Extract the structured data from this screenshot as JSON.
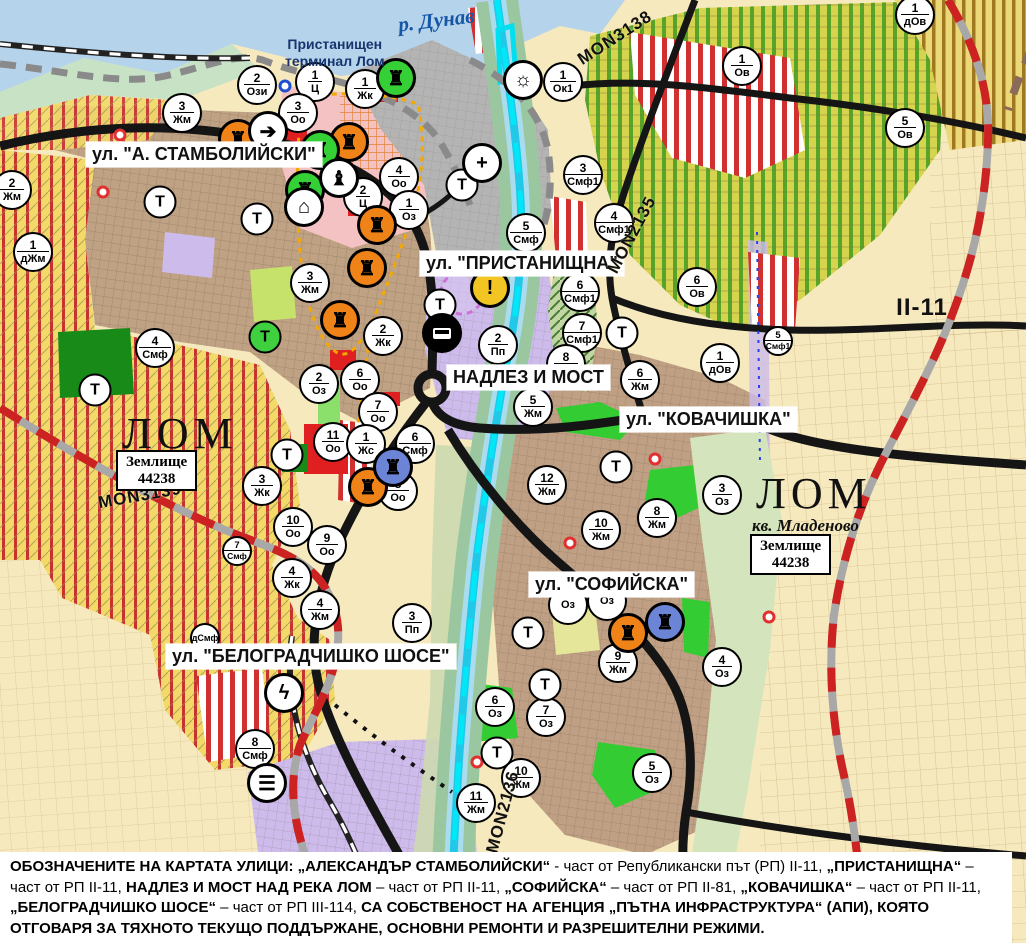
{
  "map": {
    "street_labels": [
      {
        "text": "ул. \"А. СТАМБОЛИЙСКИ\"",
        "x": 86,
        "y": 142
      },
      {
        "text": "ул. \"ПРИСТАНИЩНА\"",
        "x": 420,
        "y": 251
      },
      {
        "text": "НАДЛЕЗ И МОСТ",
        "x": 447,
        "y": 365
      },
      {
        "text": "ул. \"КОВАЧИШКА\"",
        "x": 620,
        "y": 407
      },
      {
        "text": "ул. \"СОФИЙСКА\"",
        "x": 529,
        "y": 572
      },
      {
        "text": "ул. \"БЕЛОГРАДЧИШКО ШОСЕ\"",
        "x": 166,
        "y": 644
      }
    ],
    "river_label": {
      "text": "р. Дунав",
      "x": 398,
      "y": 8,
      "rot": -7
    },
    "terminal_label": {
      "text": "Пристанищен\nтерминал Лом",
      "x": 285,
      "y": 36
    },
    "city_labels": [
      {
        "text": "ЛОМ",
        "x": 122,
        "y": 412
      },
      {
        "text": "ЛОМ",
        "x": 756,
        "y": 472
      }
    ],
    "quarter_label": {
      "text": "кв. Младеново",
      "x": 752,
      "y": 516
    },
    "land_boxes": [
      {
        "text": "Землище\n44238",
        "x": 116,
        "y": 450
      },
      {
        "text": "Землище\n44238",
        "x": 750,
        "y": 534
      }
    ],
    "road_labels": [
      {
        "text": "MON3138",
        "x": 615,
        "y": 38,
        "rot": -33,
        "fs": 17
      },
      {
        "text": "MON2135",
        "x": 632,
        "y": 235,
        "rot": -62,
        "fs": 17
      },
      {
        "text": "MON3139",
        "x": 140,
        "y": 496,
        "rot": -10,
        "fs": 17
      },
      {
        "text": "MON2136",
        "x": 503,
        "y": 812,
        "rot": -75,
        "fs": 17
      },
      {
        "text": "II-11",
        "x": 922,
        "y": 308,
        "rot": 0,
        "fs": 24
      }
    ],
    "zone_markers": [
      {
        "num": "2",
        "code": "Ози",
        "x": 257,
        "y": 85
      },
      {
        "num": "1",
        "code": "Ц",
        "x": 315,
        "y": 82
      },
      {
        "num": "3",
        "code": "Оо",
        "x": 298,
        "y": 113
      },
      {
        "num": "1",
        "code": "Жк",
        "x": 365,
        "y": 89
      },
      {
        "num": "1",
        "code": "Ок1",
        "x": 563,
        "y": 82
      },
      {
        "num": "3",
        "code": "Жм",
        "x": 182,
        "y": 113
      },
      {
        "num": "2",
        "code": "Жм",
        "x": 12,
        "y": 190
      },
      {
        "num": "1",
        "code": "дЖм",
        "x": 33,
        "y": 252
      },
      {
        "num": "4",
        "code": "Оо",
        "x": 399,
        "y": 177
      },
      {
        "num": "2",
        "code": "Ц",
        "x": 363,
        "y": 197
      },
      {
        "num": "1",
        "code": "Оз",
        "x": 409,
        "y": 210
      },
      {
        "num": "3",
        "code": "Смф1",
        "x": 583,
        "y": 175
      },
      {
        "num": "5",
        "code": "Смф",
        "x": 526,
        "y": 233
      },
      {
        "num": "4",
        "code": "Смф1",
        "x": 614,
        "y": 223
      },
      {
        "num": "6",
        "code": "Ов",
        "x": 697,
        "y": 287
      },
      {
        "num": "1",
        "code": "Ов",
        "x": 742,
        "y": 66
      },
      {
        "num": "5",
        "code": "Ов",
        "x": 905,
        "y": 128
      },
      {
        "num": "1",
        "code": "дОв",
        "x": 915,
        "y": 15
      },
      {
        "num": "1",
        "code": "дОв",
        "x": 720,
        "y": 363
      },
      {
        "num": "6",
        "code": "Смф1",
        "x": 580,
        "y": 292
      },
      {
        "num": "7",
        "code": "Смф1",
        "x": 582,
        "y": 333
      },
      {
        "num": "5",
        "code": "Смф1",
        "x": 778,
        "y": 341,
        "small": true
      },
      {
        "num": "3",
        "code": "Жм",
        "x": 310,
        "y": 283
      },
      {
        "num": "2",
        "code": "Жк",
        "x": 383,
        "y": 336
      },
      {
        "num": "4",
        "code": "Смф",
        "x": 155,
        "y": 348
      },
      {
        "num": "2",
        "code": "Пп",
        "x": 498,
        "y": 345
      },
      {
        "num": "2",
        "code": "Оз",
        "x": 319,
        "y": 384
      },
      {
        "num": "6",
        "code": "Оо",
        "x": 360,
        "y": 380
      },
      {
        "num": "7",
        "code": "Оо",
        "x": 378,
        "y": 412
      },
      {
        "num": "11",
        "code": "Оо",
        "x": 333,
        "y": 442
      },
      {
        "num": "1",
        "code": "Жс",
        "x": 366,
        "y": 444
      },
      {
        "num": "6",
        "code": "Смф",
        "x": 415,
        "y": 444
      },
      {
        "num": "8",
        "code": "Оо",
        "x": 398,
        "y": 491
      },
      {
        "num": "3",
        "code": "Жк",
        "x": 262,
        "y": 486
      },
      {
        "num": "10",
        "code": "Оо",
        "x": 293,
        "y": 527
      },
      {
        "num": "9",
        "code": "Оо",
        "x": 327,
        "y": 545
      },
      {
        "num": "4",
        "code": "Жк",
        "x": 292,
        "y": 578
      },
      {
        "num": "4",
        "code": "Жм",
        "x": 320,
        "y": 610
      },
      {
        "num": "3",
        "code": "Пп",
        "x": 412,
        "y": 623
      },
      {
        "num": "7",
        "code": "Смф",
        "x": 237,
        "y": 551,
        "small": true
      },
      {
        "num": "",
        "code": "дСмф",
        "x": 205,
        "y": 638,
        "small": true
      },
      {
        "num": "8",
        "code": "Смф",
        "x": 255,
        "y": 749
      },
      {
        "num": "8",
        "code": "Жм",
        "x": 566,
        "y": 364
      },
      {
        "num": "6",
        "code": "Жм",
        "x": 640,
        "y": 380
      },
      {
        "num": "5",
        "code": "Жм",
        "x": 533,
        "y": 407
      },
      {
        "num": "12",
        "code": "Жм",
        "x": 547,
        "y": 485
      },
      {
        "num": "8",
        "code": "Жм",
        "x": 657,
        "y": 518
      },
      {
        "num": "10",
        "code": "Жм",
        "x": 601,
        "y": 530
      },
      {
        "num": "3",
        "code": "Оз",
        "x": 722,
        "y": 495
      },
      {
        "num": "",
        "code": "Оз",
        "x": 568,
        "y": 605
      },
      {
        "num": "",
        "code": "Оз",
        "x": 607,
        "y": 601
      },
      {
        "num": "9",
        "code": "Жм",
        "x": 618,
        "y": 663
      },
      {
        "num": "6",
        "code": "Оз",
        "x": 495,
        "y": 707
      },
      {
        "num": "7",
        "code": "Оз",
        "x": 546,
        "y": 717
      },
      {
        "num": "10",
        "code": "Жм",
        "x": 521,
        "y": 778
      },
      {
        "num": "11",
        "code": "Жм",
        "x": 476,
        "y": 803
      },
      {
        "num": "5",
        "code": "Оз",
        "x": 652,
        "y": 773
      },
      {
        "num": "4",
        "code": "Оз",
        "x": 722,
        "y": 667
      }
    ],
    "t_markers": [
      {
        "x": 160,
        "y": 202
      },
      {
        "x": 257,
        "y": 219
      },
      {
        "x": 95,
        "y": 390
      },
      {
        "x": 265,
        "y": 337,
        "bg": "#3fd03f"
      },
      {
        "x": 287,
        "y": 455
      },
      {
        "x": 440,
        "y": 305
      },
      {
        "x": 462,
        "y": 185
      },
      {
        "x": 622,
        "y": 333
      },
      {
        "x": 616,
        "y": 467
      },
      {
        "x": 528,
        "y": 633
      },
      {
        "x": 545,
        "y": 685
      },
      {
        "x": 497,
        "y": 753
      }
    ],
    "poi_icons": [
      {
        "name": "industry-icon",
        "glyph": "♜",
        "bg": "#ef8318",
        "x": 238,
        "y": 139
      },
      {
        "name": "industry-icon",
        "glyph": "♜",
        "bg": "#ef8318",
        "x": 349,
        "y": 142
      },
      {
        "name": "industry-icon",
        "glyph": "♜",
        "bg": "#ef8318",
        "x": 377,
        "y": 225
      },
      {
        "name": "industry-icon",
        "glyph": "♜",
        "bg": "#ef8318",
        "x": 367,
        "y": 268
      },
      {
        "name": "industry-icon",
        "glyph": "♜",
        "bg": "#ef8318",
        "x": 340,
        "y": 320
      },
      {
        "name": "industry-icon",
        "glyph": "♜",
        "bg": "#ef8318",
        "x": 368,
        "y": 487
      },
      {
        "name": "industry-icon",
        "glyph": "♜",
        "bg": "#ef8318",
        "x": 628,
        "y": 633
      },
      {
        "name": "industry-icon-blue",
        "glyph": "♜",
        "bg": "#6b84d6",
        "x": 393,
        "y": 467
      },
      {
        "name": "industry-icon-blue",
        "glyph": "♜",
        "bg": "#6b84d6",
        "x": 665,
        "y": 622
      },
      {
        "name": "industry-icon-green",
        "glyph": "♜",
        "bg": "#35d035",
        "x": 320,
        "y": 150
      },
      {
        "name": "industry-icon-green",
        "glyph": "♜",
        "bg": "#35d035",
        "x": 305,
        "y": 190
      },
      {
        "name": "port-terminal-icon",
        "glyph": "♜",
        "bg": "#35d035",
        "x": 396,
        "y": 78
      },
      {
        "name": "one-way-icon",
        "glyph": "➔",
        "bg": "#ffffff",
        "x": 268,
        "y": 131
      },
      {
        "name": "monument-icon",
        "glyph": "♝",
        "bg": "#ffffff",
        "x": 339,
        "y": 178
      },
      {
        "name": "arch-icon",
        "glyph": "⌂",
        "bg": "#ffffff",
        "x": 304,
        "y": 207
      },
      {
        "name": "hospital-icon",
        "glyph": "+",
        "bg": "#ffffff",
        "x": 482,
        "y": 163
      },
      {
        "name": "sun-port-icon",
        "glyph": "☼",
        "bg": "#ffffff",
        "x": 523,
        "y": 80
      },
      {
        "name": "bus-station-icon",
        "glyph": "bus",
        "bg": "#000000",
        "x": 442,
        "y": 333
      },
      {
        "name": "power-icon",
        "glyph": "ϟ",
        "bg": "#ffffff",
        "x": 284,
        "y": 693
      },
      {
        "name": "rail-station-icon",
        "glyph": "☰",
        "bg": "#ffffff",
        "x": 267,
        "y": 783
      },
      {
        "name": "warning-icon",
        "glyph": "!",
        "bg": "#f3c522",
        "x": 490,
        "y": 288
      }
    ],
    "point_rings": [
      {
        "color": "#e03030",
        "x": 120,
        "y": 135
      },
      {
        "color": "#e03030",
        "x": 103,
        "y": 192
      },
      {
        "color": "#e03030",
        "x": 655,
        "y": 459
      },
      {
        "color": "#e03030",
        "x": 769,
        "y": 617
      },
      {
        "color": "#e03030",
        "x": 477,
        "y": 762
      },
      {
        "color": "#e03030",
        "x": 570,
        "y": 543
      },
      {
        "color": "#2050d0",
        "x": 285,
        "y": 86
      }
    ],
    "colors": {
      "danube": "#b5d3ea",
      "residential": "#bfa183",
      "industrial_purple": "#cdbbec",
      "center_pink": "#f4c2c2",
      "port_gray": "#b4b4b4",
      "park_green": "#33cc33",
      "road_black": "#151515",
      "repair_red_dash": "#cc2222",
      "river_cyan": "#22c8e8"
    }
  },
  "footer": {
    "parts": [
      {
        "t": "ОБОЗНАЧЕНИТЕ НА КАРТАТА УЛИЦИ: „АЛЕКСАНДЪР СТАМБОЛИЙСКИ“",
        "b": 1
      },
      {
        "t": " - част от Републикански път (РП) II-11, ",
        "b": 0
      },
      {
        "t": "„ПРИСТАНИЩНА“",
        "b": 1
      },
      {
        "t": " – част от РП II-11, ",
        "b": 0
      },
      {
        "t": "НАДЛЕЗ И МОСТ НАД РЕКА ЛОМ",
        "b": 1
      },
      {
        "t": " – част от РП II-11, ",
        "b": 0
      },
      {
        "t": "„СОФИЙСКА“",
        "b": 1
      },
      {
        "t": " – част от РП II-81, ",
        "b": 0
      },
      {
        "t": "„КОВАЧИШКА“",
        "b": 1
      },
      {
        "t": " – част от РП II-11, ",
        "b": 0
      },
      {
        "t": "„БЕЛОГРАДЧИШКО ШОСЕ“",
        "b": 1
      },
      {
        "t": " – част от РП III-114, ",
        "b": 0
      },
      {
        "t": "СА СОБСТВЕНОСТ НА АГЕНЦИЯ „ПЪТНА ИНФРАСТРУКТУРА“ (АПИ), КОЯТО ОТГОВАРЯ ЗА ТЯХНОТО ТЕКУЩО ПОДДЪРЖАНЕ, ОСНОВНИ РЕМОНТИ И РАЗРЕШИТЕЛНИ РЕЖИМИ.",
        "b": 1
      }
    ]
  }
}
